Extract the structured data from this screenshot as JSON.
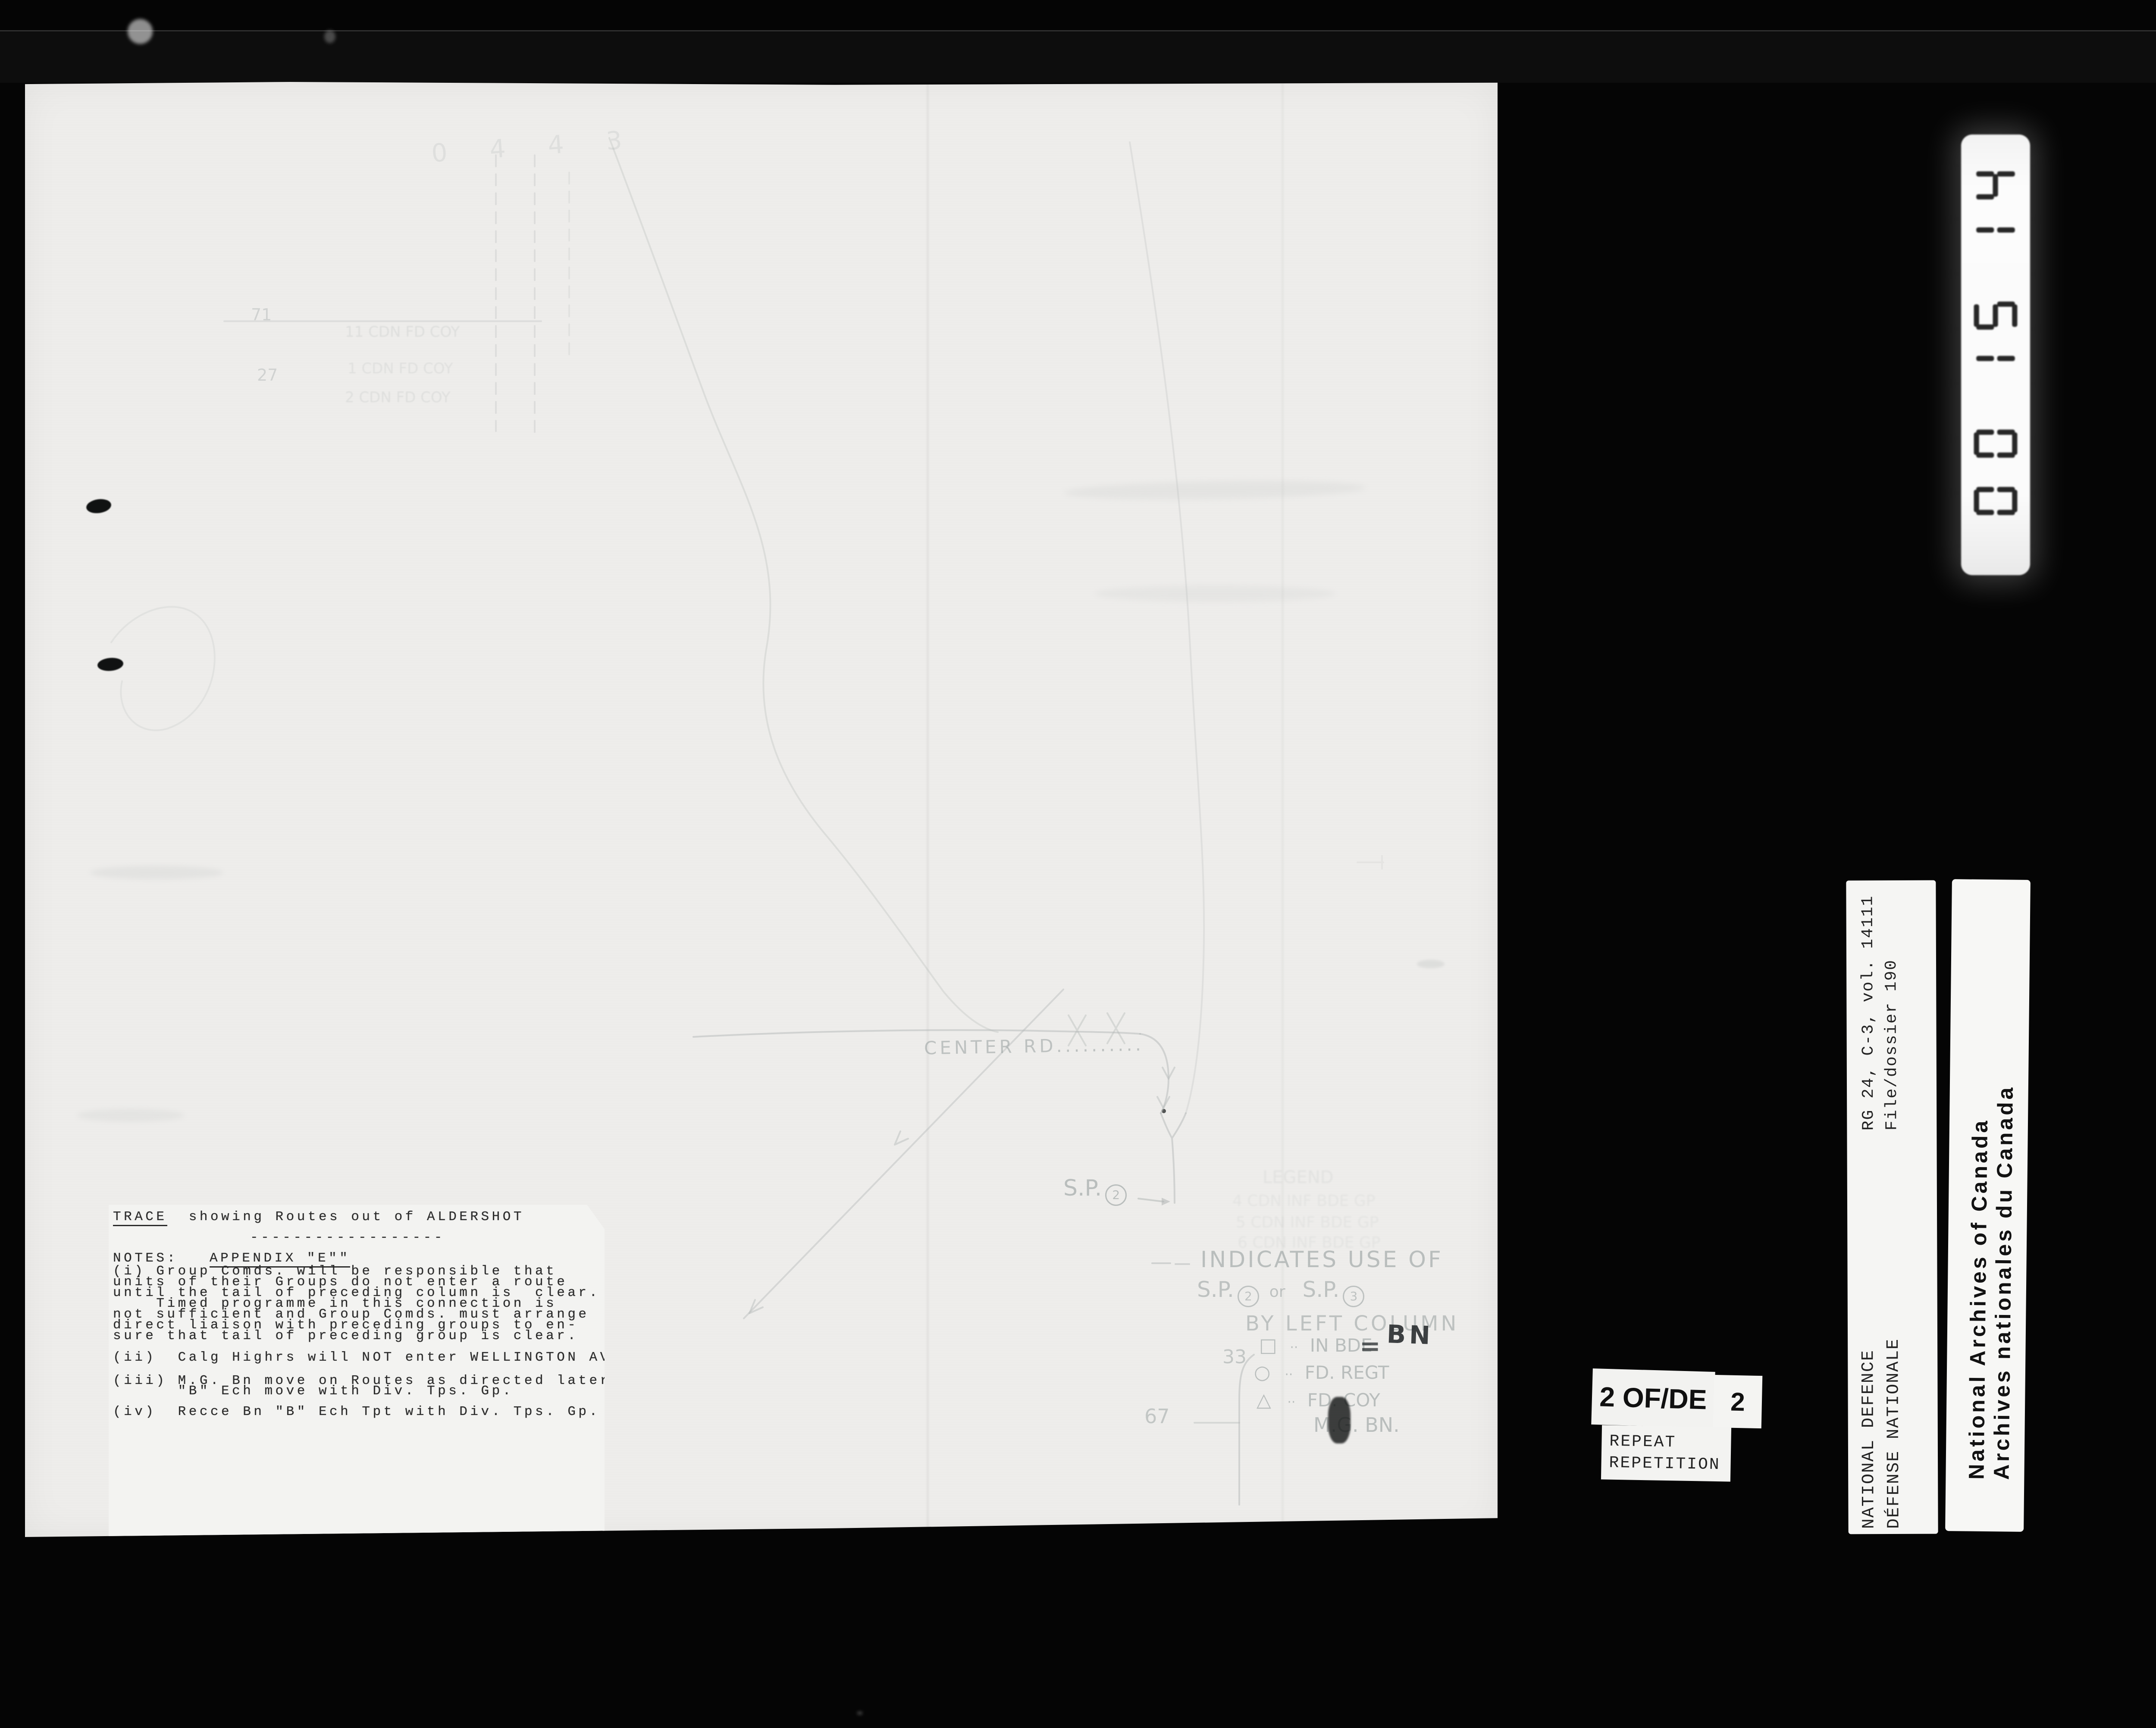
{
  "film": {
    "counter": "001514",
    "page_label": "2 OF/DE",
    "page_total": "2",
    "stamp": [
      "REPEAT",
      "REPETITION"
    ]
  },
  "labels": {
    "rg": [
      "RG 24, C-3, vol. 14111",
      "File/dossier 190"
    ],
    "dept": [
      "NATIONAL DEFENCE",
      "DÉFENSE NATIONALE"
    ],
    "archives": [
      "National Archives of Canada",
      "Archives nationales du Canada"
    ]
  },
  "doc": {
    "title_word": "TRACE",
    "title_rest": "  showing Routes out of ALDERSHOT",
    "divider": "------------------",
    "notes_label": "NOTES:",
    "appendix": "APPENDIX \"E\"\"",
    "para_i": [
      "(i) Group Comds. will be responsible that",
      "units of their Groups do not enter a route",
      "until the tail of preceding column is  clear.",
      "    Timed programme in this connection is",
      "not sufficient and Group Comds. must arrange",
      "direct liaison with preceding groups to en-",
      "sure that tail of preceding group is clear."
    ],
    "para_ii": "(ii)  Calg Highrs will NOT enter WELLINGTON AVE.",
    "para_iii": [
      "(iii) M.G. Bn move on Routes as directed later",
      "      \"B\" Ech move with Div. Tps. Gp."
    ],
    "para_iv": "(iv)  Recce Bn \"B\" Ech Tpt with Div. Tps. Gp.",
    "map": {
      "road": "CENTER  RD..........",
      "sp": "S.P.",
      "sp_num": "2",
      "grid_71": "71",
      "grid_27": "27",
      "grid_33": "33",
      "grid_67": "67",
      "hand_marks": "0 4 4 3",
      "units": [
        "11 CDN FD COY",
        "1 CDN FD COY",
        "2 CDN FD COY"
      ],
      "faint": [
        "LEGEND",
        "4 CDN INF BDE GP",
        "5 CDN INF BDE GP",
        "6 CDN INF BDE GP"
      ],
      "legend": {
        "heading": "INDICATES USE OF",
        "sp1": "S.P.",
        "c1": "2",
        "conj": "or",
        "sp2": "S.P.",
        "c2": "3",
        "line3": "BY LEFT COLUMN",
        "i1_sym": "□",
        "i1_dots": "··",
        "i1_text": "IN BDE",
        "i1_eq": "=",
        "i1_over": "BN",
        "i2_sym": "○",
        "i2_dots": "··",
        "i2_text": "FD. REGT",
        "i3_sym": "△",
        "i3_dots": "··",
        "i3_text": "FD. COY",
        "i4_text": "M.G. BN."
      }
    }
  },
  "colors": {
    "background": "#050505",
    "paper": "#efeeec",
    "notes_paper": "#f3f3f1",
    "typed_ink": "#2b2b2b",
    "pencil": "#8f9898",
    "label_ink": "#151515"
  }
}
